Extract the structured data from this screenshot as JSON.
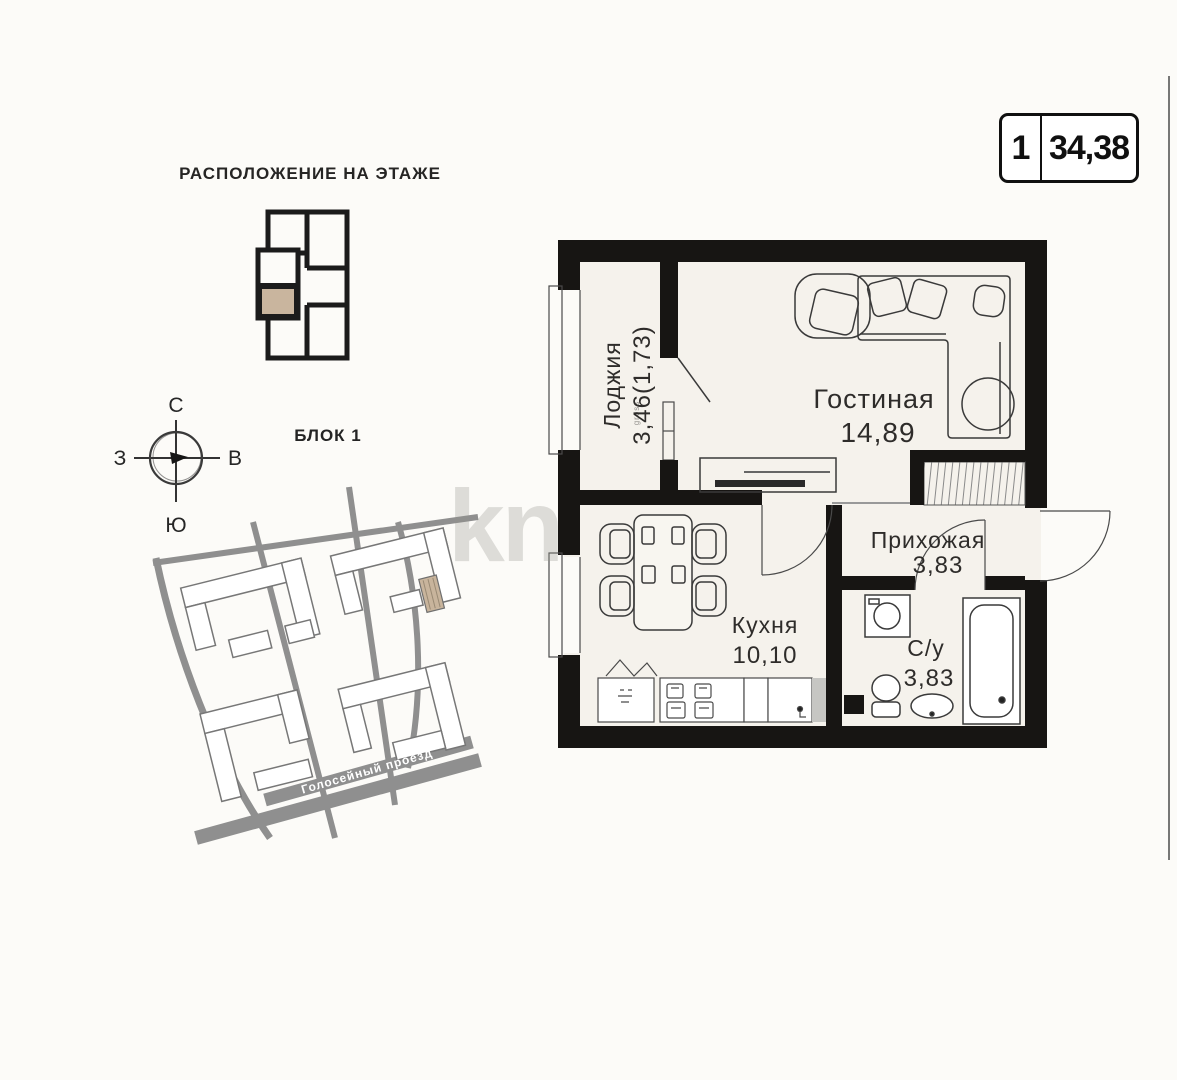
{
  "area_badge": {
    "rooms": "1",
    "area": "34,38"
  },
  "floor_plan_locator": {
    "title": "РАСПОЛОЖЕНИЕ НА ЭТАЖЕ",
    "highlight_color": "#c9b59e"
  },
  "compass": {
    "north": "С",
    "south": "Ю",
    "west": "З",
    "east": "В"
  },
  "site_map": {
    "block_label": "БЛОК 1",
    "street_label": "Голосейный проезд",
    "road_color": "#8f8f8f",
    "highlight_color": "#c8b49c"
  },
  "watermark": {
    "text": "kn"
  },
  "apartment_plan": {
    "wall_color": "#171513",
    "floor_color": "#f5f2ec",
    "rooms": [
      {
        "name": "Лоджия",
        "area": "3,46(1,73)",
        "note": "gross"
      },
      {
        "name": "Гостиная",
        "area": "14,89"
      },
      {
        "name": "Прихожая",
        "area": "3,83"
      },
      {
        "name": "Кухня",
        "area": "10,10"
      },
      {
        "name": "С/у",
        "area": "3,83"
      }
    ]
  }
}
